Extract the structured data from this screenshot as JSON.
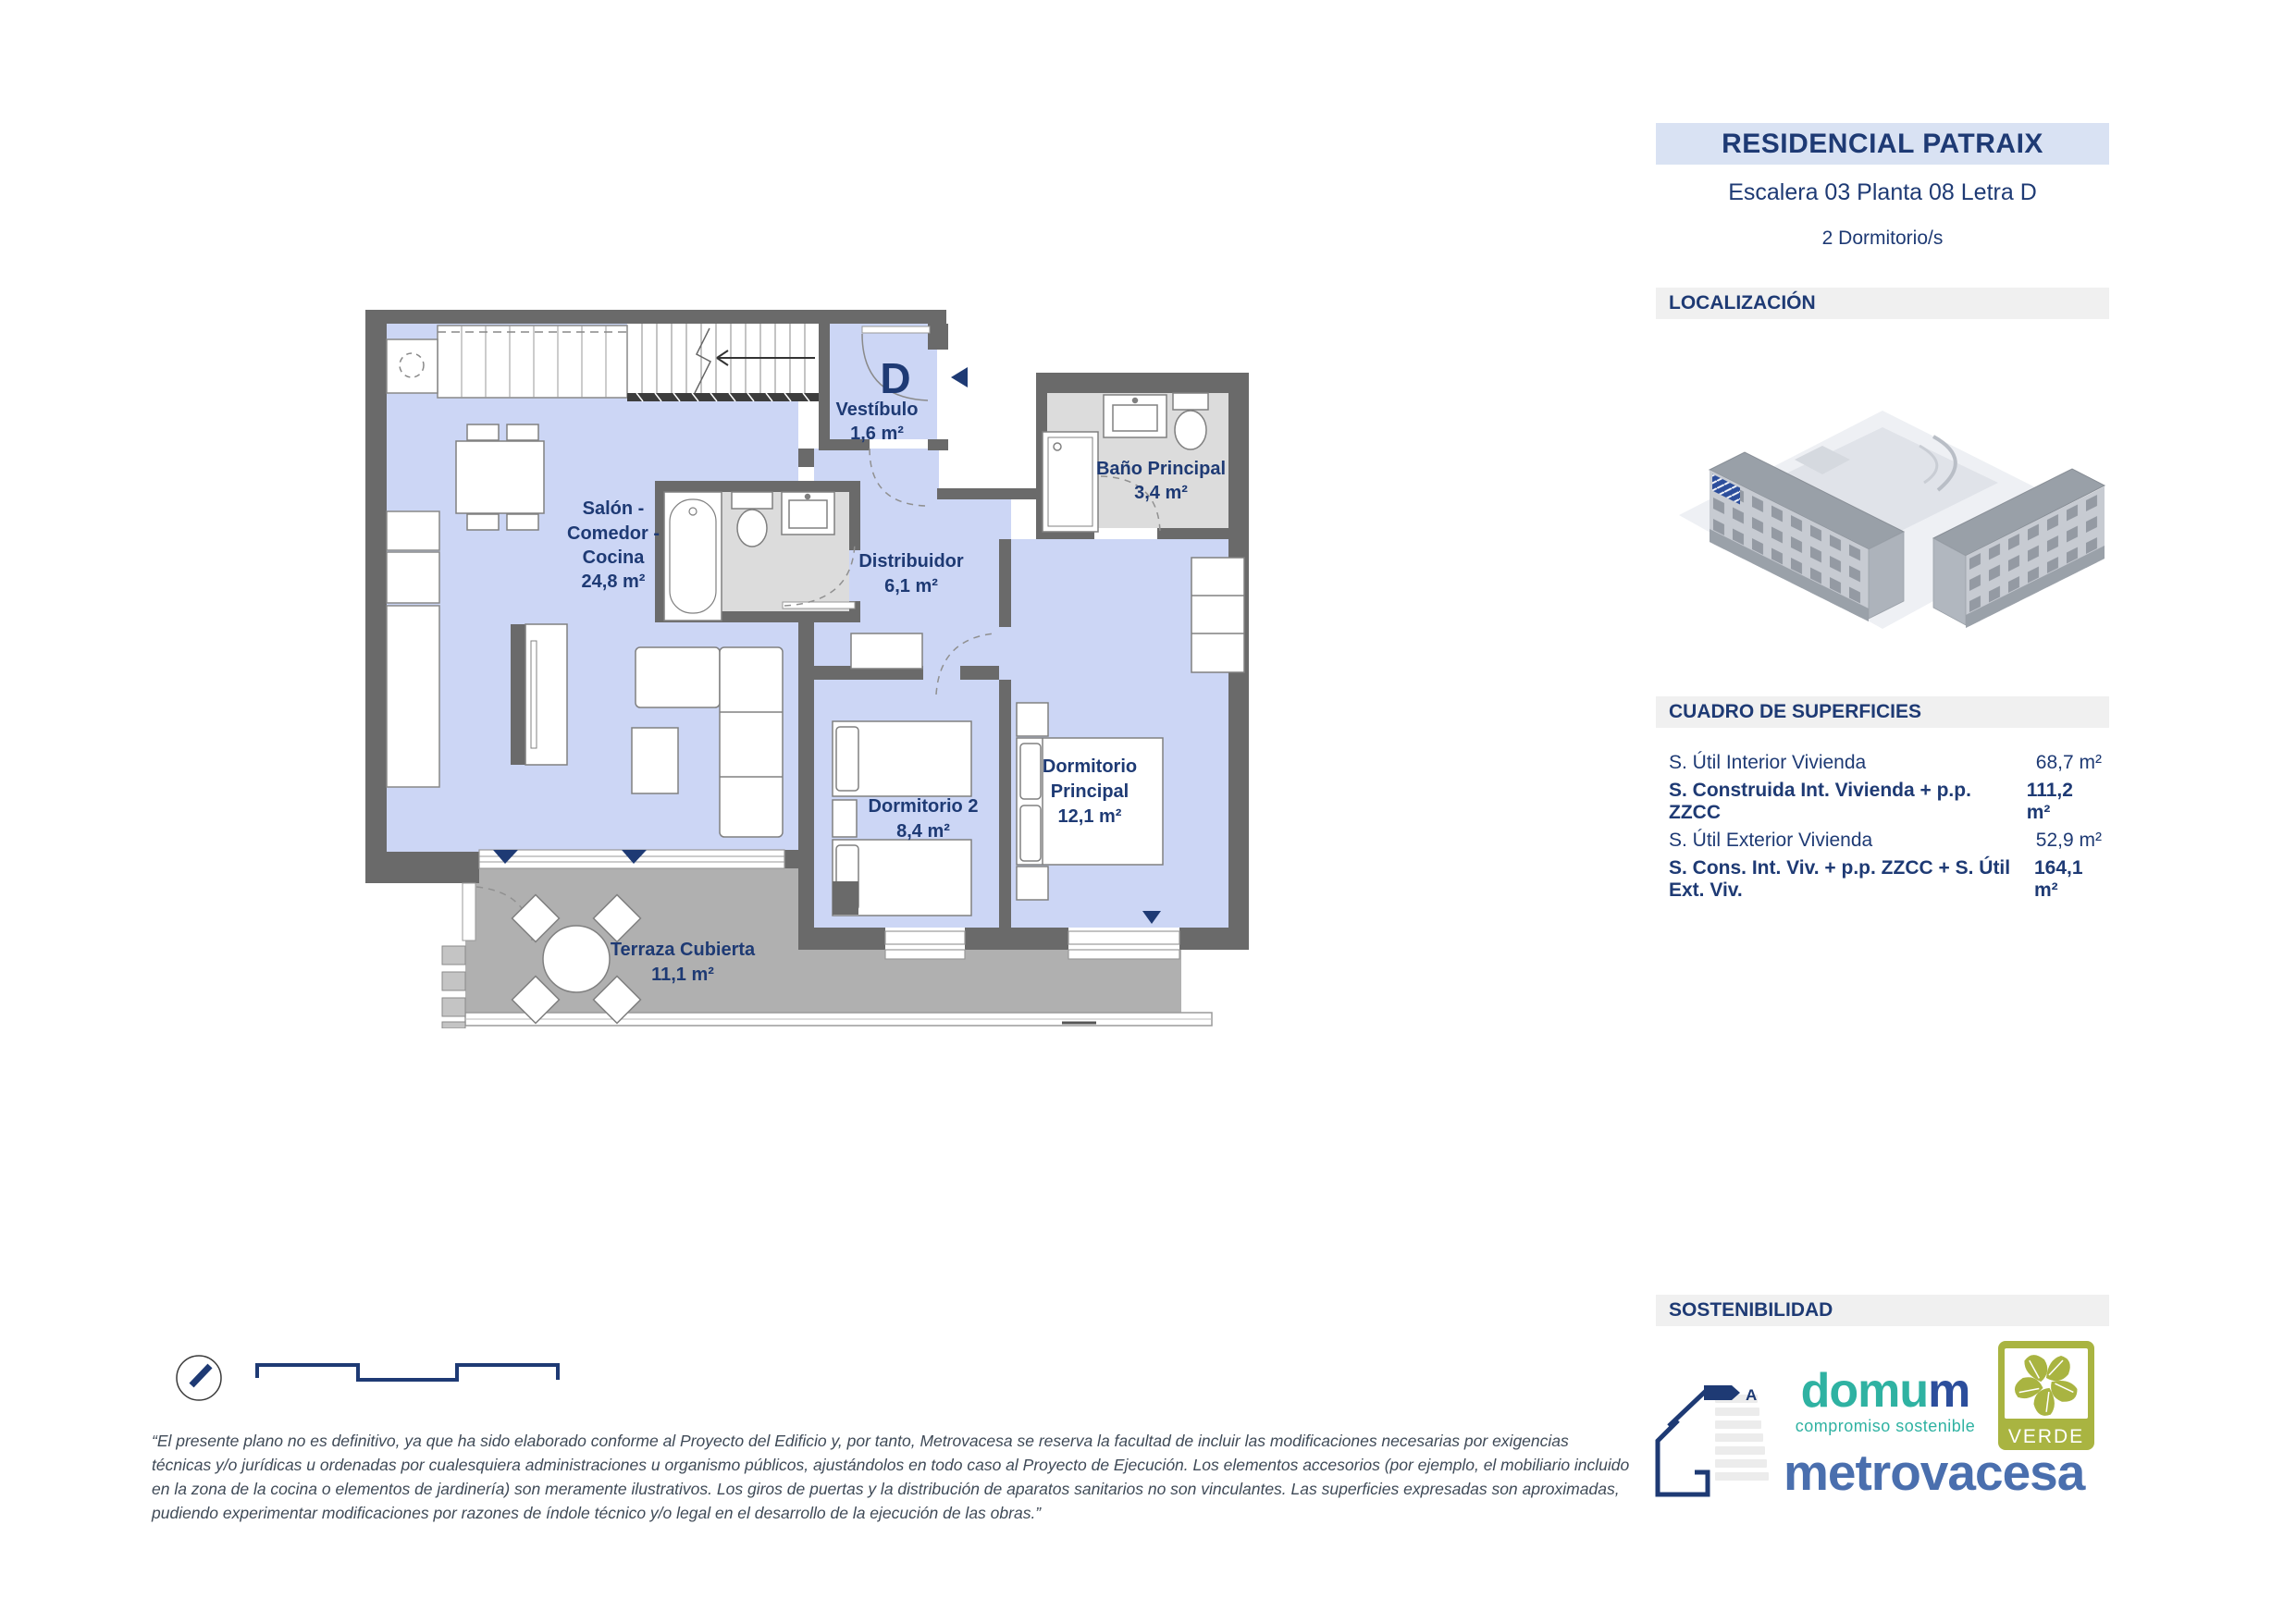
{
  "header": {
    "title": "RESIDENCIAL PATRAIX",
    "subtitle": "Escalera 03 Planta 08 Letra D",
    "bedrooms": "2 Dormitorio/s"
  },
  "sections": {
    "localizacion": "LOCALIZACIÓN",
    "superficies": "CUADRO DE SUPERFICIES",
    "sostenibilidad": "SOSTENIBILIDAD"
  },
  "surfaces": {
    "rows": [
      {
        "label": "S. Útil Interior Vivienda",
        "value": "68,7 m²"
      },
      {
        "label": "S. Construida Int. Vivienda + p.p. ZZCC",
        "value": "111,2 m²"
      },
      {
        "label": "S. Útil Exterior Vivienda",
        "value": "52,9 m²"
      },
      {
        "label": "S. Cons. Int. Viv. + p.p. ZZCC + S. Útil Ext. Viv.",
        "value": "164,1 m²"
      }
    ]
  },
  "plan": {
    "unit_letter": "D",
    "rooms": {
      "vestibulo": {
        "name": "Vestíbulo",
        "area": "1,6 m²"
      },
      "bano_principal": {
        "name": "Baño Principal",
        "area": "3,4 m²"
      },
      "salon": {
        "line1": "Salón -",
        "line2": "Comedor -",
        "line3": "Cocina",
        "area": "24,8 m²"
      },
      "distribuidor": {
        "name": "Distribuidor",
        "area": "6,1 m²"
      },
      "dormitorio_principal": {
        "line1": "Dormitorio",
        "line2": "Principal",
        "area": "12,1 m²"
      },
      "dormitorio_2": {
        "name": "Dormitorio 2",
        "area": "8,4 m²"
      },
      "terraza": {
        "name": "Terraza Cubierta",
        "area": "11,1 m²"
      }
    }
  },
  "logos": {
    "domum": {
      "part1": "domu",
      "part2": "m",
      "tagline": "compromiso sostenible"
    },
    "metrovacesa": "metrovacesa",
    "verde": "VERDE",
    "energy_rating": "A"
  },
  "footer": {
    "disclaimer": "“El presente plano no es definitivo, ya que ha sido elaborado conforme al Proyecto del Edificio y, por tanto, Metrovacesa se reserva la facultad de incluir las modificaciones necesarias por exigencias técnicas y/o jurídicas u ordenadas por cualesquiera administraciones u organismo públicos, ajustándolos en todo caso al Proyecto de Ejecución. Los elementos accesorios (por ejemplo, el mobiliario incluido en la zona de la cocina o elementos de jardinería) son meramente ilustrativos. Los giros de puertas y la distribución de aparatos sanitarios no son vinculantes. Las superficies expresadas son aproximadas, pudiendo experimentar modificaciones por razones de índole técnico y/o legal en el desarrollo de la ejecución de las obras.”"
  },
  "colors": {
    "accent": "#1e3a74",
    "floor": "#ccd6f5",
    "wall": "#6a6a6a",
    "terrace": "#b0b0b0",
    "bath_floor": "#dcdcdc",
    "header_bg": "#d9e2f3",
    "section_bg": "#f0f0f0",
    "domum_teal": "#2fb2a2",
    "metrovacesa_blue": "#4a6fae",
    "verde_green": "#a9b441"
  }
}
